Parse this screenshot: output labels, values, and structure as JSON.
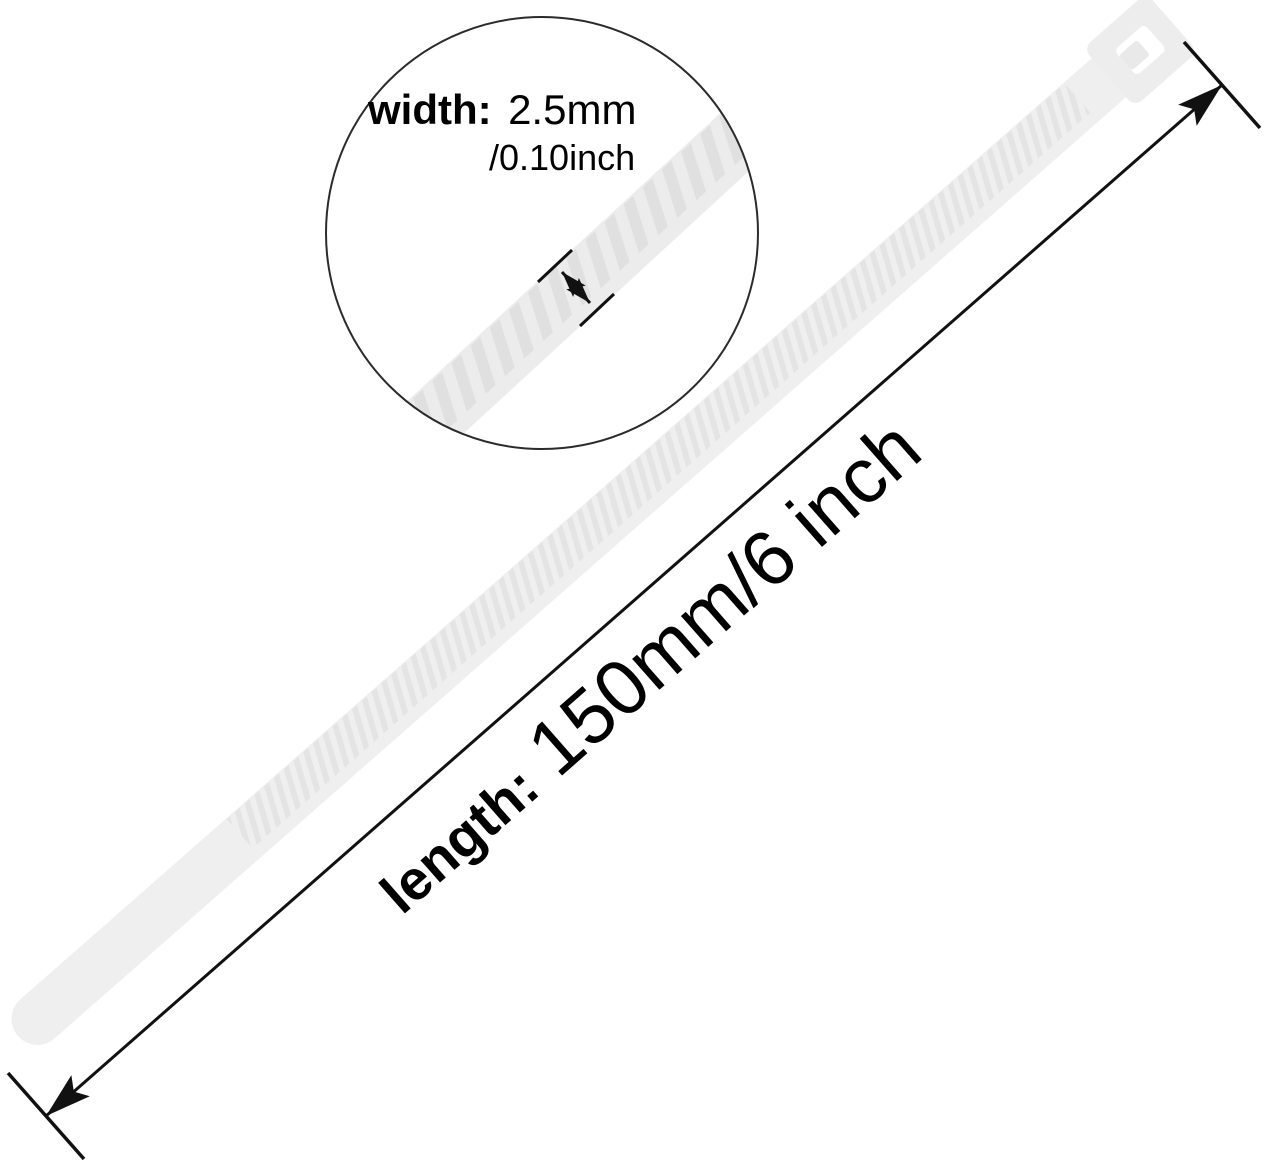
{
  "image": {
    "background": "#ffffff",
    "line_color": "#111111",
    "tie_fill": "#efefef",
    "tie_teeth": "#e4e4e4",
    "tie_head_fill": "#ededed",
    "magnified_fill": "#ececec",
    "magnified_teeth": "#e0e0e0"
  },
  "magnifier_callout": {
    "width_label": "width:",
    "width_value_mm": "2.5mm",
    "width_value_inch": "/0.10inch"
  },
  "length_callout": {
    "label": "length:",
    "value": "150mm/6 inch"
  }
}
